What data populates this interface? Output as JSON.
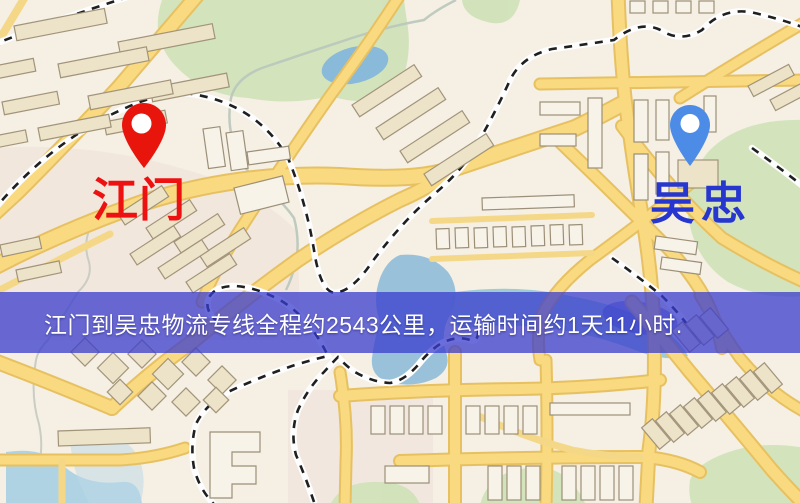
{
  "map": {
    "origin_marker": {
      "label": "江门",
      "pin_color": "#e8150d",
      "label_color": "#ee1111"
    },
    "destination_marker": {
      "label": "吴忠",
      "pin_color": "#4d8ce6",
      "label_color": "#2636cf"
    },
    "info_banner": {
      "text": "江门到吴忠物流专线全程约2543公里，运输时间约1天11小时.",
      "background_color": "#3a3ccd",
      "text_color": "#ffffff",
      "distance_km": "2543",
      "transit_time": "1天11小时"
    },
    "palette": {
      "road": "#f9da80",
      "water": "#85b7da",
      "park": "#cfe2b8",
      "railway": "#1f1f1f",
      "background": "#f5efe4"
    }
  }
}
